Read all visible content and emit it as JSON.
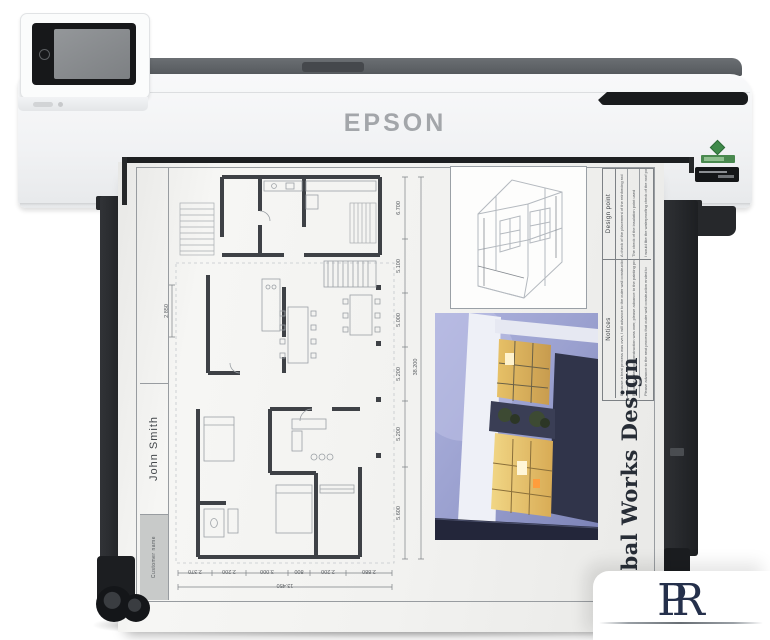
{
  "brand": {
    "logo_text": "EPSON"
  },
  "sheet": {
    "customer_label": "Customer name",
    "customer_value": "John Smith",
    "title": "Global Works Design",
    "notes": {
      "design_header": "Design point",
      "design_rows": [
        "A check of the placement of the reinforcing rod",
        "The check of the insulation point used",
        "I would like the waterproofing check of the roof point"
      ],
      "notices_header": "Notices",
      "notices_rows": [
        "Because a beat process was over, I will advance to the outer wall construction",
        "Because outer wall construction was over, please advance to the painting process",
        "Please advance to the next process that outer wall construction ended to"
      ]
    },
    "dims_right": [
      "6.700",
      "5.100",
      "5.000",
      "5.200",
      "5.200",
      "5.600"
    ],
    "dims_right_total": "38.200",
    "dims_bottom": [
      "2.370",
      "2.200",
      "3.000",
      "800",
      "2.200",
      "2.880"
    ],
    "dims_bottom_total": "13.450",
    "dim_left": "2.850"
  },
  "watermark": {
    "letters": [
      "P",
      "R"
    ]
  },
  "colors": {
    "accent_blue": "#3b6fc5",
    "navy": "#25304b",
    "eco_green": "#3f8a4a"
  }
}
